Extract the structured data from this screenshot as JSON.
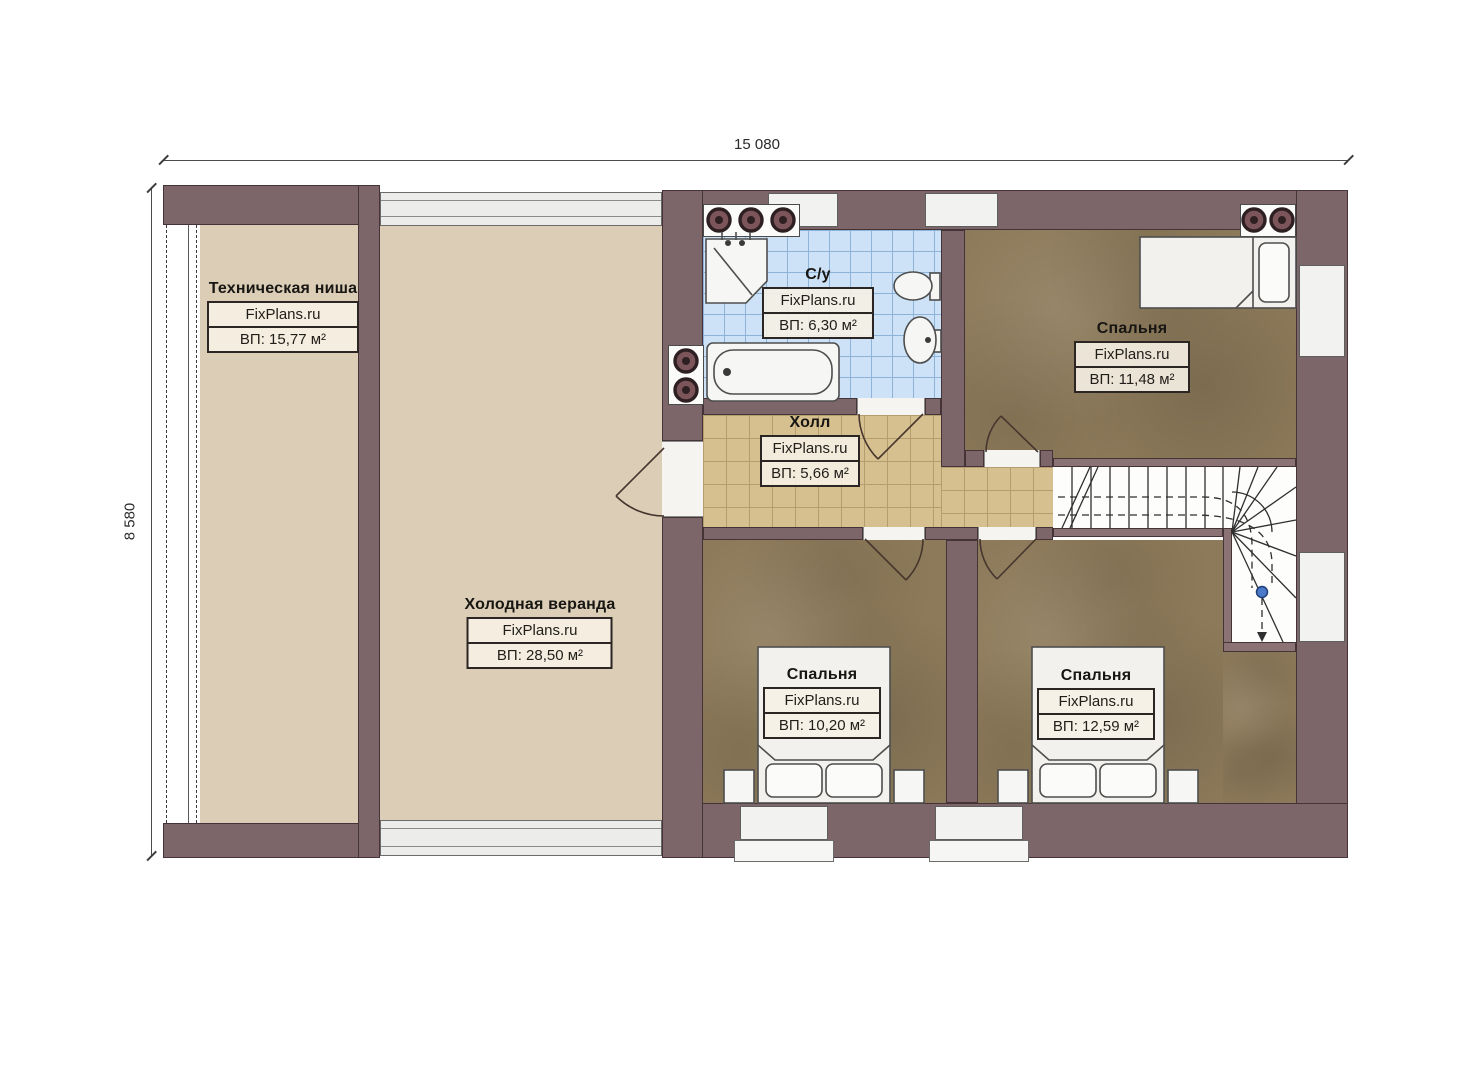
{
  "dimensions": {
    "width_label": "15 080",
    "height_label": "8 580"
  },
  "rooms": [
    {
      "key": "tech-niche",
      "name": "Техническая ниша",
      "brand": "FixPlans.ru",
      "area": "ВП: 15,77 м²"
    },
    {
      "key": "veranda",
      "name": "Холодная веранда",
      "brand": "FixPlans.ru",
      "area": "ВП: 28,50 м²"
    },
    {
      "key": "bathroom",
      "name": "С/у",
      "brand": "FixPlans.ru",
      "area": "ВП: 6,30 м²"
    },
    {
      "key": "hall",
      "name": "Холл",
      "brand": "FixPlans.ru",
      "area": "ВП: 5,66 м²"
    },
    {
      "key": "bedroom-top",
      "name": "Спальня",
      "brand": "FixPlans.ru",
      "area": "ВП: 11,48 м²"
    },
    {
      "key": "bedroom-bottom-left",
      "name": "Спальня",
      "brand": "FixPlans.ru",
      "area": "ВП: 10,20 м²"
    },
    {
      "key": "bedroom-bottom-right",
      "name": "Спальня",
      "brand": "FixPlans.ru",
      "area": "ВП: 12,59 м²"
    }
  ],
  "colors": {
    "wall": "#7d6669",
    "wall_outline": "#443438",
    "floor_tan": "#dbcdb6",
    "hall_tile": "#d6c08f",
    "bedroom_floor": "#8d7a5a",
    "bath_tile": "#cde2f6",
    "label_border": "#2b2623",
    "fixture_outline": "#4e4e4e",
    "stair_dot_blue": "#4a79c9"
  }
}
